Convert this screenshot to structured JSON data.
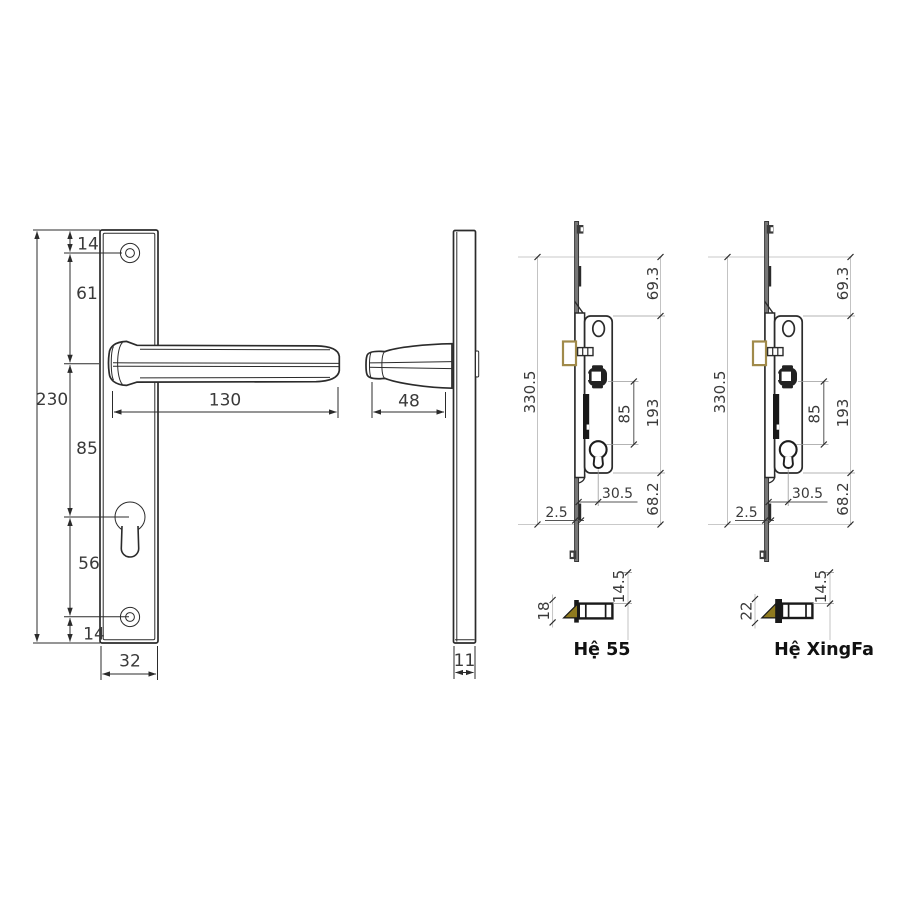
{
  "front_view": {
    "dim_total_height": "230",
    "dim_top_to_screw": "14",
    "dim_screw_to_handle": "61",
    "dim_handle_to_cylinder": "85",
    "dim_cylinder_to_screw": "56",
    "dim_screw_to_bottom": "14",
    "dim_plate_width": "32",
    "dim_handle_length": "130"
  },
  "side_view": {
    "dim_handle_depth": "48",
    "dim_plate_thickness": "11"
  },
  "lock_he55": {
    "label": "Hệ 55",
    "dim_total_length": "330.5",
    "dim_top_section": "69.3",
    "dim_body_length": "193",
    "dim_bottom_section": "68.2",
    "dim_spindle_to_cylinder": "85",
    "dim_backset": "30.5",
    "dim_faceplate_thickness": "2.5",
    "dim_bolt_height": "18",
    "dim_bolt_depth": "14.5"
  },
  "lock_xingfa": {
    "label": "Hệ XingFa",
    "dim_total_length": "330.5",
    "dim_top_section": "69.3",
    "dim_body_length": "193",
    "dim_bottom_section": "68.2",
    "dim_spindle_to_cylinder": "85",
    "dim_backset": "30.5",
    "dim_faceplate_thickness": "2.5",
    "dim_bolt_height": "22",
    "dim_bolt_depth": "14.5"
  },
  "colors": {
    "line": "#2b2b2b",
    "guide": "#c9c9c9",
    "latch_outline": "#a08a4a",
    "latch_fill": "#8f7a1f"
  }
}
